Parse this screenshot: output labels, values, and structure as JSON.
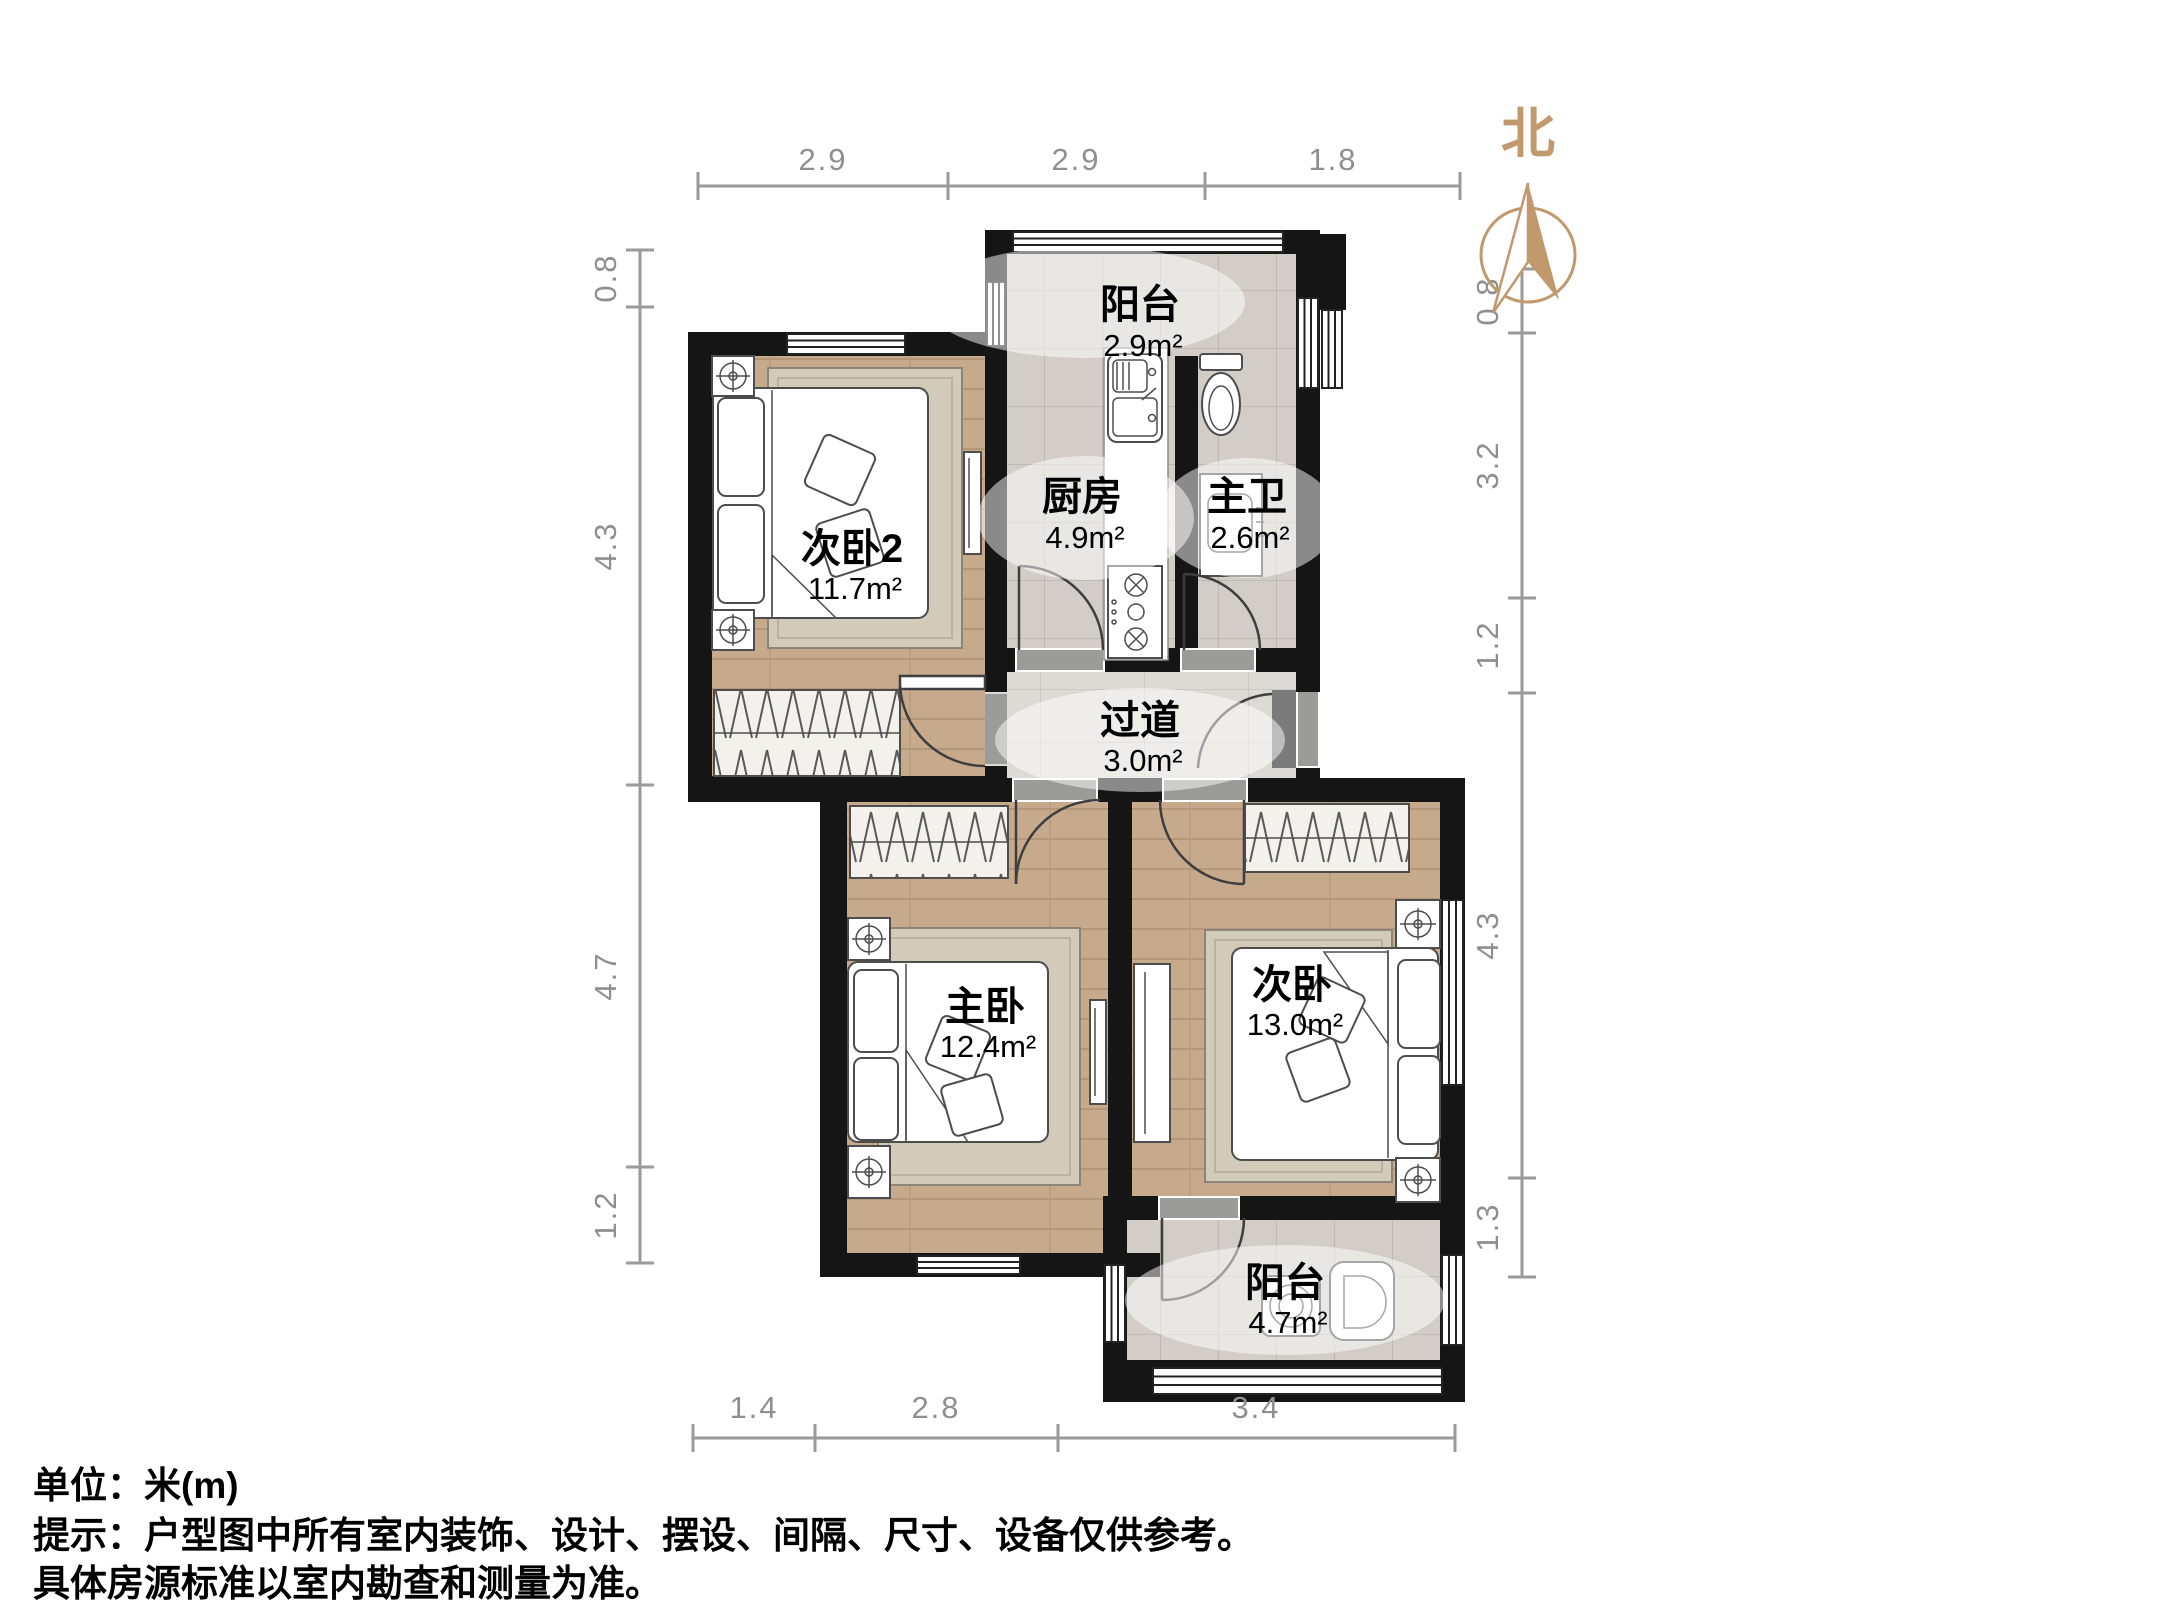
{
  "compass": {
    "label": "北"
  },
  "rooms": {
    "balcony_top": {
      "name": "阳台",
      "area": "2.9m²"
    },
    "kitchen": {
      "name": "厨房",
      "area": "4.9m²"
    },
    "master_bath": {
      "name": "主卫",
      "area": "2.6m²"
    },
    "bedroom2": {
      "name": "次卧2",
      "area": "11.7m²"
    },
    "hallway": {
      "name": "过道",
      "area": "3.0m²"
    },
    "master_bedroom": {
      "name": "主卧",
      "area": "12.4m²"
    },
    "bedroom": {
      "name": "次卧",
      "area": "13.0m²"
    },
    "balcony_bottom": {
      "name": "阳台",
      "area": "4.7m²"
    }
  },
  "dimensions": {
    "top": [
      "2.9",
      "2.9",
      "1.8"
    ],
    "left": [
      "0.8",
      "4.3",
      "4.7",
      "1.2"
    ],
    "right": [
      "0.8",
      "3.2",
      "1.2",
      "4.3",
      "1.3"
    ],
    "bottom": [
      "1.4",
      "2.8",
      "3.4"
    ]
  },
  "notes": {
    "unit": "单位：米(m)",
    "disclaimer1": "提示：户型图中所有室内装饰、设计、摆设、间隔、尺寸、设备仅供参考。",
    "disclaimer2": "具体房源标准以室内勘查和测量为准。"
  },
  "colors": {
    "wall": "#151515",
    "wood_floor": "#c7a98b",
    "tile_floor": "#d2cec7",
    "hall_floor": "#dddad5",
    "compass": "#c2996c",
    "dimension": "#8f8f8f"
  }
}
